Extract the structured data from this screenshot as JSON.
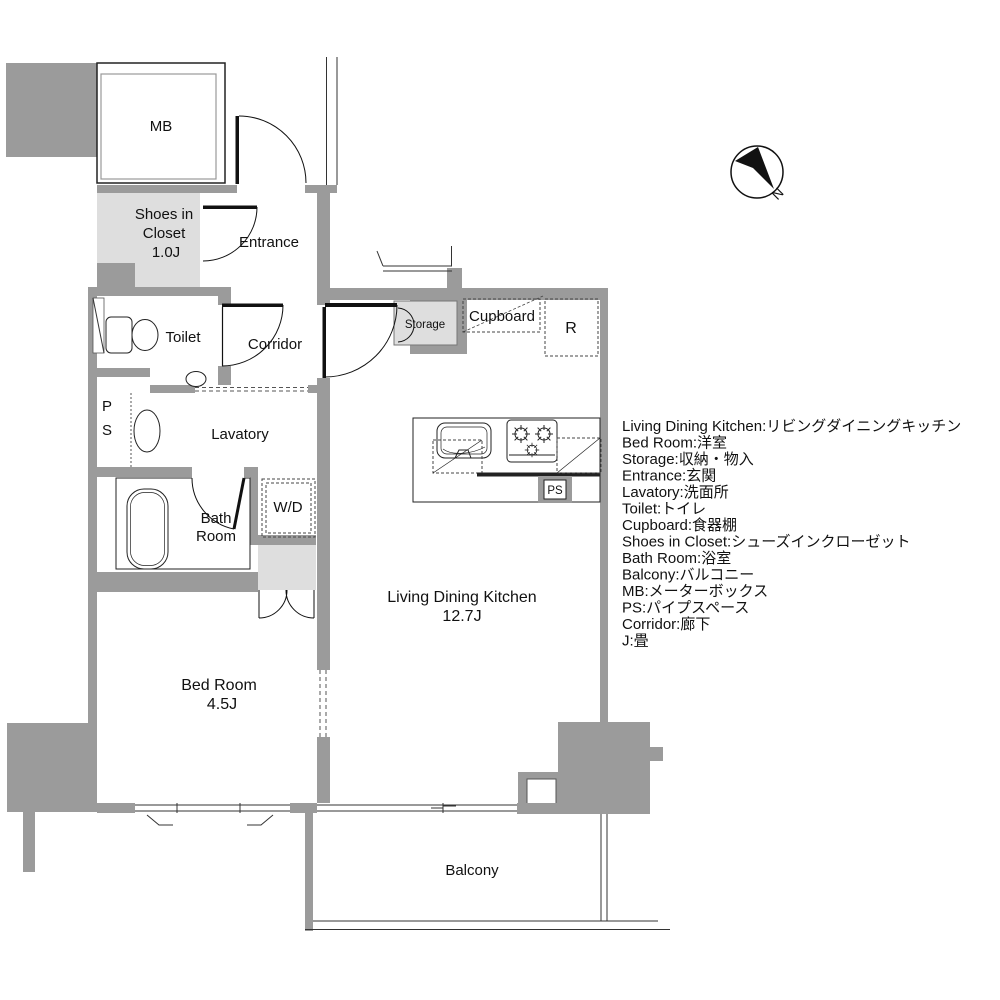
{
  "colors": {
    "wall_gray": "#9b9b9b",
    "light_gray": "#dedede",
    "line_black": "#111111",
    "background": "#ffffff"
  },
  "rooms": {
    "mb": "MB",
    "shoes_line1": "Shoes in",
    "shoes_line2": "Closet",
    "shoes_line3": "1.0J",
    "entrance": "Entrance",
    "toilet": "Toilet",
    "corridor": "Corridor",
    "ps_left_line1": "P",
    "ps_left_line2": "S",
    "lavatory": "Lavatory",
    "bath_line1": "Bath",
    "bath_line2": "Room",
    "wd": "W/D",
    "storage": "Storage",
    "cupboard": "Cupboard",
    "refrigerator": "R",
    "ps_kitchen": "PS",
    "ldk_line1": "Living Dining Kitchen",
    "ldk_line2": "12.7J",
    "bedroom_line1": "Bed Room",
    "bedroom_line2": "4.5J",
    "balcony": "Balcony"
  },
  "compass": {
    "north": "N"
  },
  "legend": {
    "lines": [
      "Living Dining Kitchen:リビングダイニングキッチン",
      "Bed Room:洋室",
      "Storage:収納・物入",
      "Entrance:玄関",
      "Lavatory:洗面所",
      "Toilet:トイレ",
      "Cupboard:食器棚",
      "Shoes in Closet:シューズインクローゼット",
      "Bath Room:浴室",
      "Balcony:バルコニー",
      "MB:メーターボックス",
      "PS:パイプスペース",
      "Corridor:廊下",
      "J:畳"
    ]
  }
}
